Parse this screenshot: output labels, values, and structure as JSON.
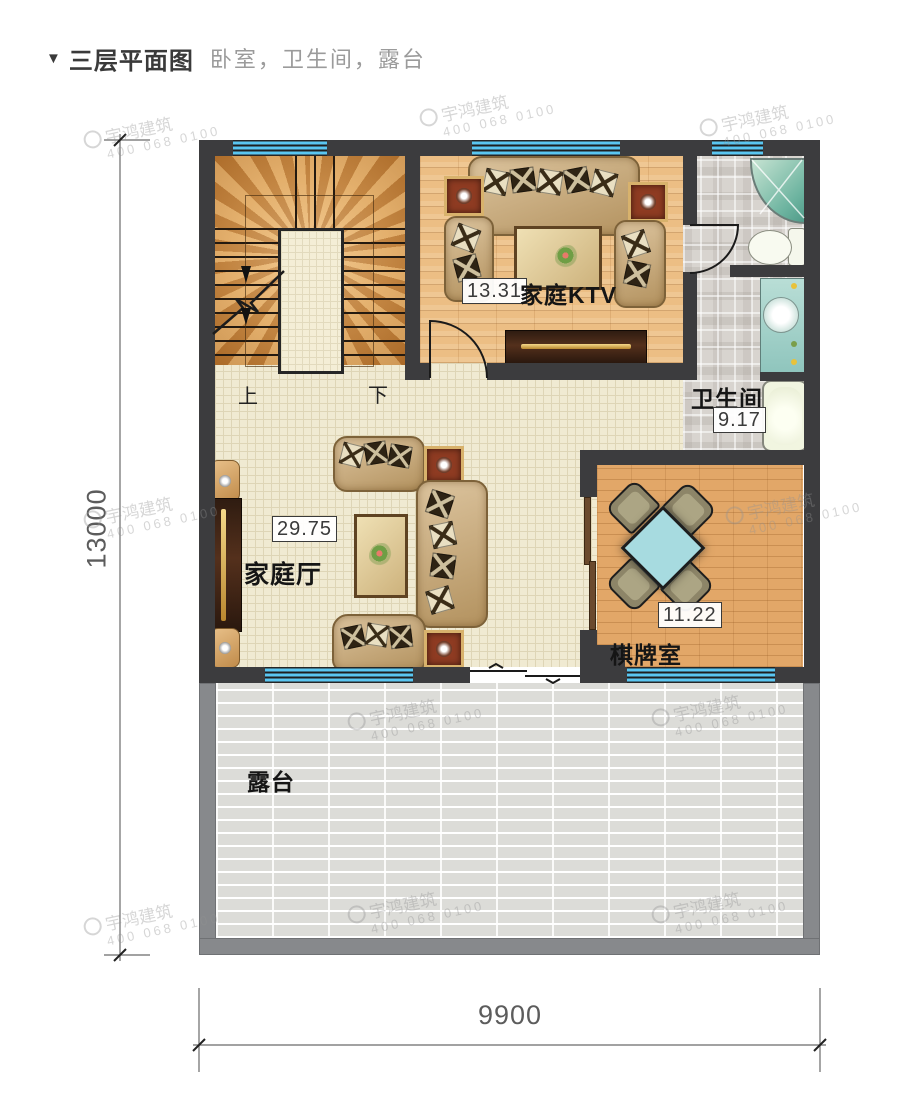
{
  "title": {
    "marker": "▼",
    "main": "三层平面图",
    "subtitle": "卧室，卫生间，露台"
  },
  "rooms": {
    "ktv": {
      "name": "家庭KTV",
      "area": "13.31"
    },
    "hall": {
      "name": "家庭厅",
      "area": "29.75"
    },
    "bath": {
      "name": "卫生间",
      "area": "9.17"
    },
    "chess": {
      "name": "棋牌室",
      "area": "11.22"
    },
    "terrace": {
      "name": "露台"
    }
  },
  "stairs": {
    "up_label": "上",
    "down_label": "下"
  },
  "dimensions": {
    "bottom": "9900",
    "left": "13000"
  },
  "watermark": {
    "brand": "宇鸿建筑",
    "phone": "400 068 0100"
  },
  "colors": {
    "wall": "#3c3c3e",
    "terrace_wall": "#87898c",
    "window_blue": "#5ac6f1",
    "wood_floor": "#ecbe84",
    "hall_floor": "#f0ead2",
    "accent_red": "#8e3b22",
    "chess_table_cyan": "#a7dbe0"
  }
}
